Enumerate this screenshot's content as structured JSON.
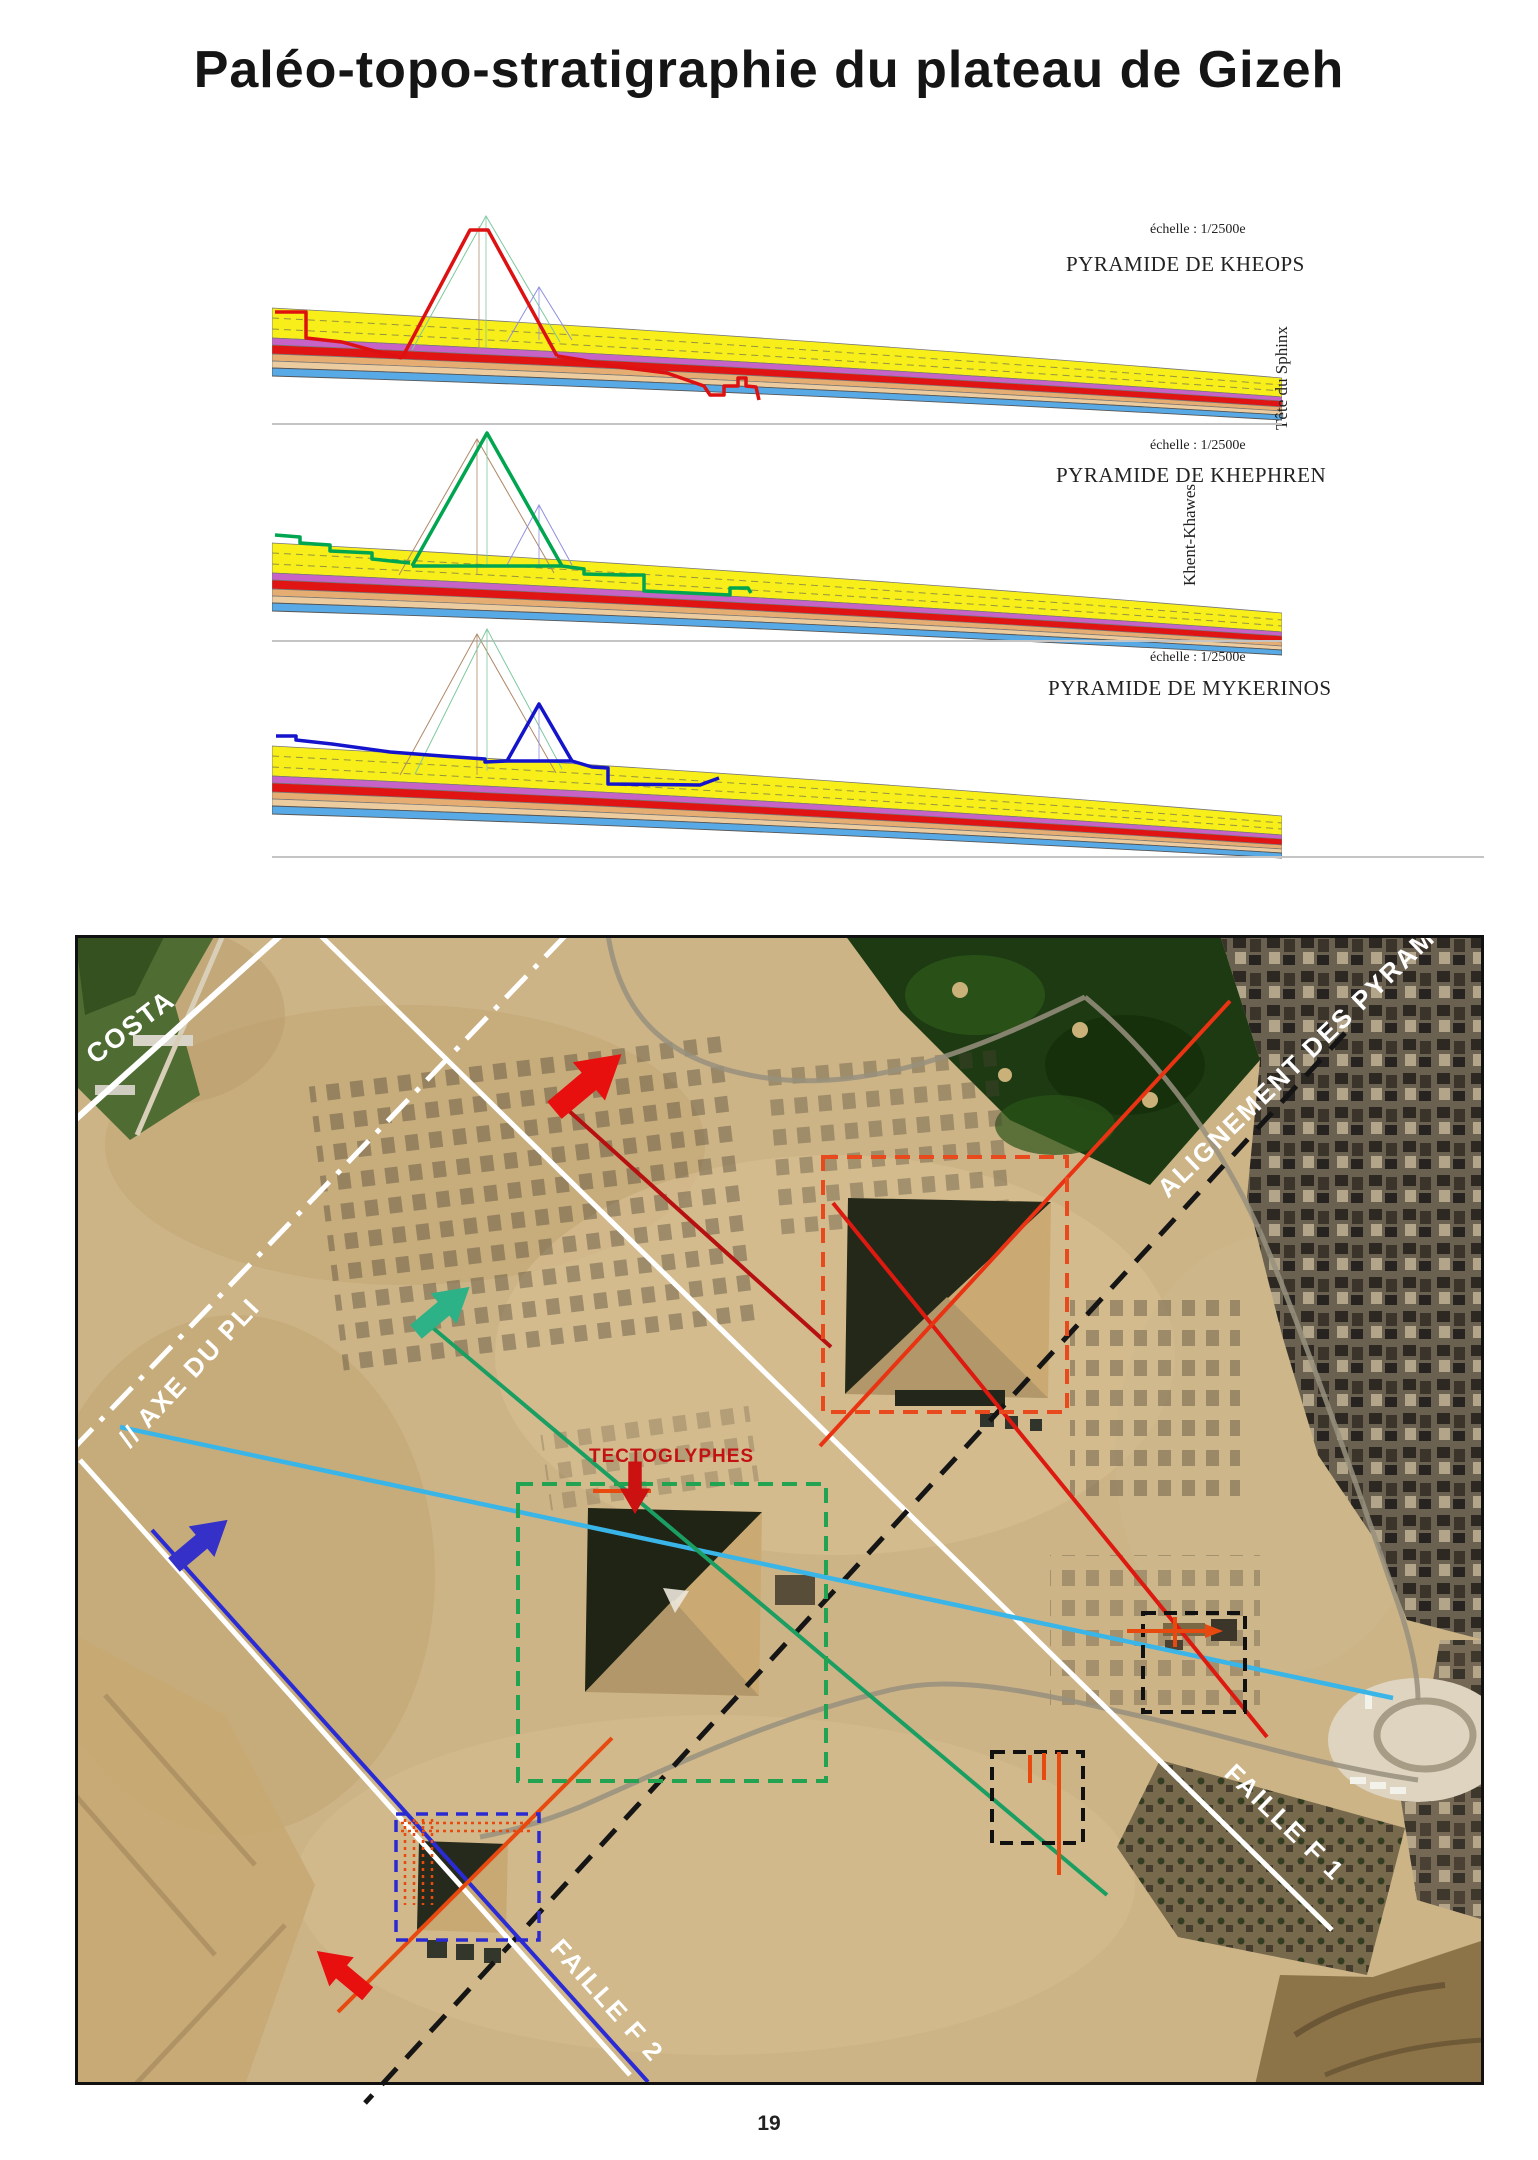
{
  "page": {
    "title": "Paléo-topo-stratigraphie du plateau de Gizeh",
    "page_number": "19"
  },
  "sections": [
    {
      "scale_label": "échelle : 1/2500e",
      "title": "PYRAMIDE DE KHEOPS",
      "side_label": "Tête du Sphinx",
      "profile_color": "#dd1111"
    },
    {
      "scale_label": "échelle : 1/2500e",
      "title": "PYRAMIDE DE KHEPHREN",
      "side_label": "Khent-Khawes",
      "profile_color": "#00a550"
    },
    {
      "scale_label": "échelle : 1/2500e",
      "title": "PYRAMIDE DE MYKERINOS",
      "side_label": "",
      "profile_color": "#1414cc"
    }
  ],
  "strata_colors": {
    "yellow": "#f7ee1a",
    "violet": "#c763c7",
    "red": "#e11414",
    "tan": "#e5ad72",
    "light_tan": "#eccb9e",
    "blue": "#58aae6"
  },
  "map": {
    "labels": {
      "costa": "COSTA",
      "alignement": "ALIGNEMENT DES PYRAMIDES",
      "axe_du_pli": "// AXE DU PLI",
      "tectoglyphes": "TECTOGLYPHES",
      "faille_f1": "FAILLE F 1",
      "faille_f2": "FAILLE F 2"
    },
    "annotation_colors": {
      "fault_white": "#ffffff",
      "alignment_black": "#151515",
      "fold_axis_cyan": "#3ab5e8",
      "tectoglyph_red": "#c21212",
      "kheops_box_orange": "#e8491d",
      "khephren_box_green": "#21a352",
      "mykerinos_box_blue": "#2a2ad0",
      "arrow_red": "#e80f0f",
      "arrow_teal": "#2cb286",
      "arrow_blue": "#3531c8",
      "line_orange": "#e8490f",
      "line_green": "#1b9e62",
      "line_red": "#dd1a10"
    }
  }
}
